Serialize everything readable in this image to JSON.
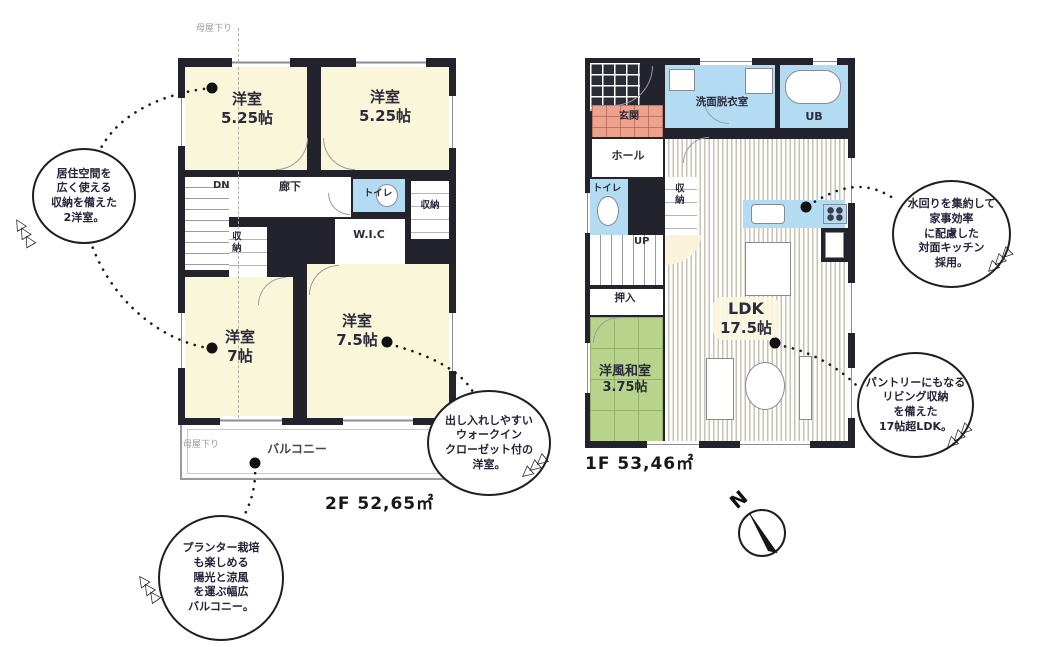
{
  "floor2": {
    "title": "2F 52,65㎡",
    "roof_note": "母屋下り",
    "balcony_roof_note": "母屋下り",
    "rooms": {
      "bed1_name": "洋室",
      "bed1_size": "5.25帖",
      "bed2_name": "洋室",
      "bed2_size": "5.25帖",
      "bed3_name": "洋室",
      "bed3_size": "7帖",
      "bed4_name": "洋室",
      "bed4_size": "7.5帖",
      "stairs": "DN",
      "hallway": "廊下",
      "toilet": "トイレ",
      "closet_right": "収納",
      "closet_mid": "収納",
      "wic": "W.I.C",
      "balcony": "バルコニー"
    }
  },
  "floor1": {
    "title": "1F 53,46㎡",
    "compass": "N",
    "rooms": {
      "entrance": "玄関",
      "washroom": "洗面脱衣室",
      "bath": "UB",
      "hall": "ホール",
      "toilet": "トイレ",
      "closet": "収納",
      "stairs": "UP",
      "oshiire": "押入",
      "ldk_name": "LDK",
      "ldk_size": "17.5帖",
      "washitsu_name": "洋風和室",
      "washitsu_size": "3.75帖"
    }
  },
  "callouts": {
    "two_rooms": {
      "lines": [
        "居住空間を",
        "広く使える",
        "収納を備えた",
        "2洋室。"
      ]
    },
    "balcony": {
      "lines": [
        "プランター栽培",
        "も楽しめる",
        "陽光と涼風",
        "を運ぶ幅広",
        "バルコニー。"
      ]
    },
    "wic": {
      "lines": [
        "出し入れしやすい",
        "ウォークイン",
        "クローゼット付の",
        "洋室。"
      ]
    },
    "kitchen": {
      "lines": [
        "水回りを集約して",
        "家事効率",
        "に配慮した",
        "対面キッチン",
        "採用。"
      ]
    },
    "ldk": {
      "lines": [
        "パントリーにもなる",
        "リビング収納",
        "を備えた",
        "17帖超LDK。"
      ]
    }
  },
  "decorations": {
    "triangles": "◁◁◁"
  },
  "colors": {
    "wall": "#23232d",
    "room_cream": "#faf6da",
    "water_blue": "#b3dcf2",
    "entrance_pink": "#eca28c",
    "tatami_green": "#b7d38c"
  }
}
